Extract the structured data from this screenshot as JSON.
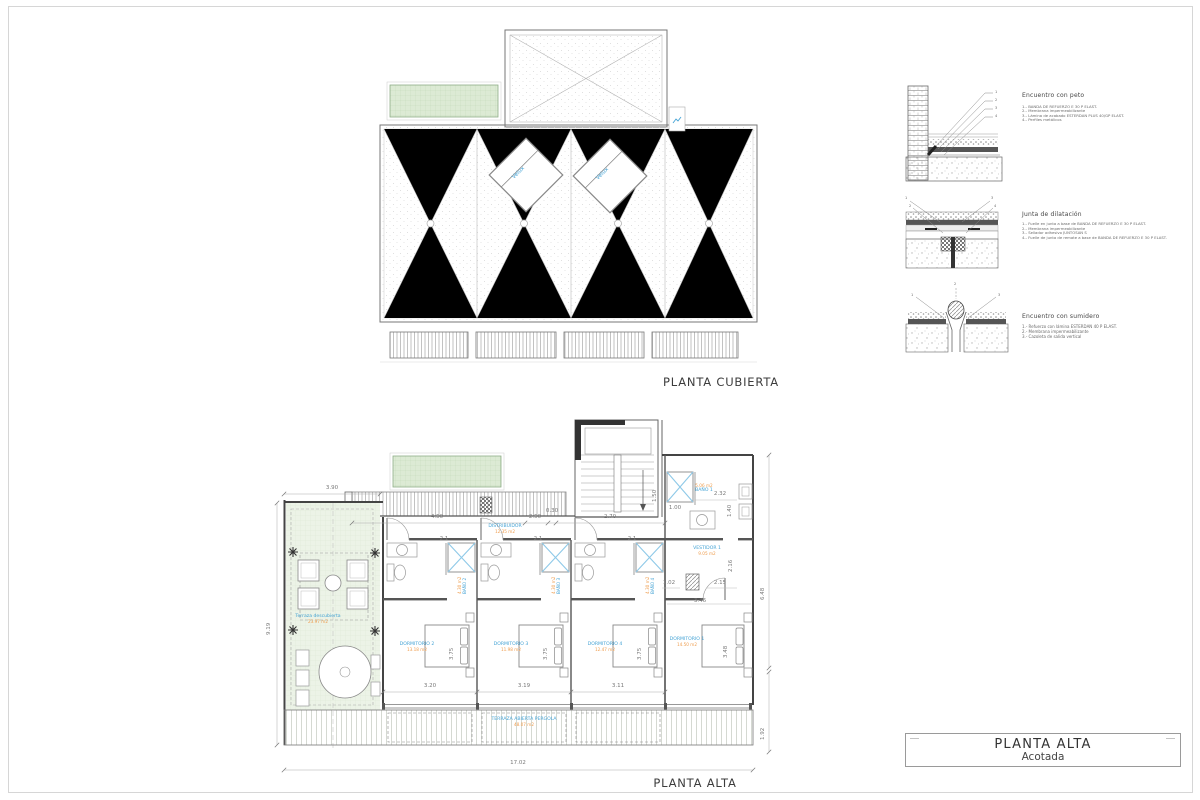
{
  "colors": {
    "label_blue": "#44a3d5",
    "area_orange": "#ef9d4e",
    "green_fill": "#dcead4"
  },
  "sheet": {
    "roof_plan_title": "PLANTA CUBIERTA",
    "floor_plan_title": "PLANTA ALTA"
  },
  "roof_plan": {
    "skylight1": "Velux",
    "skylight2": "Velux"
  },
  "callout_numbers": [
    "1",
    "2",
    "3",
    "4"
  ],
  "details": [
    {
      "title": "Encuentro con peto",
      "notes": [
        "1.- BANDA DE REFUERZO E 30 P ELAST.",
        "2.- Membrana impermeabilizante",
        "3.- Lámina de acabado ESTERDAN PLUS 40/GP ELAST.",
        "4.- Perfiles metálicos"
      ]
    },
    {
      "title": "Junta de dilatación",
      "notes": [
        "1.- Fuelle en junta a base de BANDA DE REFUERZO E 30 P ELAST.",
        "2.- Membrana impermeabilizante",
        "3.- Sellador adhesivo JUNTOSAN S",
        "4.- Fuelle de junta de remate a base de BANDA DE REFUERZO E 30 P ELAST."
      ]
    },
    {
      "title": "Encuentro con sumidero",
      "notes": [
        "1.- Refuerzo con lámina ESTERDAN 40 P ELAST.",
        "2.- Membrana impermeabilizante",
        "3.- Cazoleta de salida vertical"
      ]
    }
  ],
  "floor_plan": {
    "rooms": {
      "distribuidor": {
        "name": "DISTRIBUIDOR",
        "area": "12.35 m2"
      },
      "bano1": {
        "name": "BAÑO 1",
        "area": "5.06 m2"
      },
      "bano2": {
        "name": "BAÑO 2",
        "area": "4.30 m2"
      },
      "bano3": {
        "name": "BAÑO 3",
        "area": "4.30 m2"
      },
      "bano4": {
        "name": "BAÑO 4",
        "area": "4.30 m2"
      },
      "vestidor1": {
        "name": "VESTIDOR 1",
        "area": "9.05 m2"
      },
      "dormitorio1": {
        "name": "DORMITORIO 1",
        "area": "14.50 m2"
      },
      "dormitorio2": {
        "name": "DORMITORIO 2",
        "area": "13.18 m2"
      },
      "dormitorio3": {
        "name": "DORMITORIO 3",
        "area": "11.98 m2"
      },
      "dormitorio4": {
        "name": "DORMITORIO 4",
        "area": "12.47 m2"
      },
      "terraza": {
        "name": "Terraza descubierta",
        "area": "23.97 m2"
      },
      "pergola": {
        "name": "TERRAZA ABIERTA PERGOLA",
        "area": "48.07 m2"
      }
    },
    "dims": {
      "d390": "3.90",
      "d450": "4.50",
      "d250": "2.50",
      "d030": "0.30",
      "d270": "2.70",
      "d919": "9.19",
      "d1702": "17.02",
      "d648": "6.48",
      "d192": "1.92",
      "d320": "3.20",
      "d319": "3.19",
      "d311": "3.11",
      "d375": "3.75",
      "d21": "2.1",
      "d232": "2.32",
      "d150": "1.50",
      "d100": "1.00",
      "d140": "1.40",
      "d102": "1.02",
      "d215": "2.15",
      "d216": "2.16",
      "d346": "3.46",
      "d348": "3.48"
    }
  },
  "title_block": {
    "line1": "PLANTA ALTA",
    "line2": "Acotada"
  }
}
